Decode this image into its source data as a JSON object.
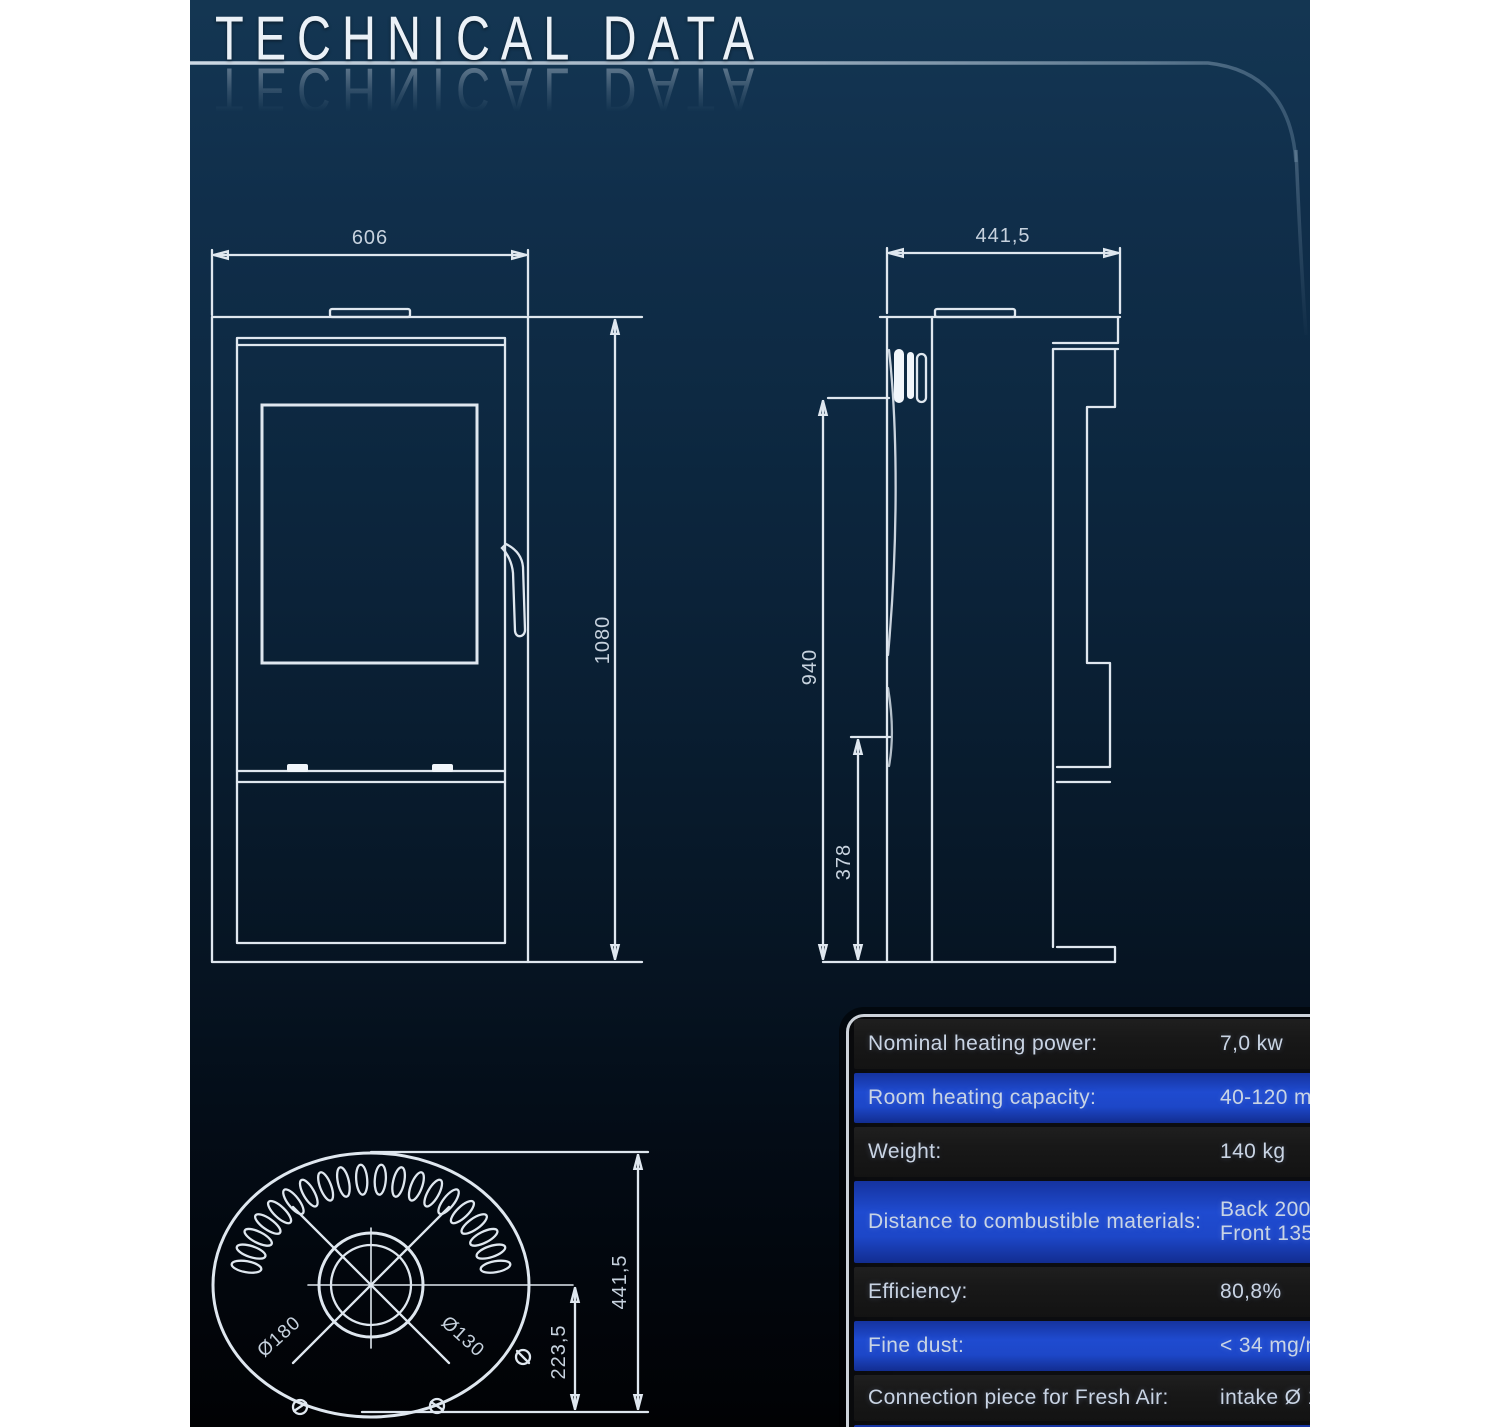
{
  "page": {
    "title": "TECHNICAL DATA"
  },
  "front_view": {
    "width_label": "606",
    "height_label": "1080"
  },
  "side_view": {
    "depth_label": "441,5",
    "height_label": "940",
    "lower_height_label": "378"
  },
  "top_view": {
    "outer_diameter_label": "Ø180",
    "inner_diameter_label": "Ø130",
    "offset_label": "223,5",
    "depth_label": "441,5"
  },
  "spec_table": {
    "rows": [
      {
        "label": "Nominal heating power:",
        "value": "7,0 kw"
      },
      {
        "label": "Room heating capacity:",
        "value": "40-120 m²"
      },
      {
        "label": "Weight:",
        "value": "140 kg"
      },
      {
        "label": "Distance to combustible materials:",
        "value": "Back 200mm/Side 200mm/\nFront 1350mm"
      },
      {
        "label": "Efficiency:",
        "value": "80,8%"
      },
      {
        "label": "Fine dust:",
        "value": "< 34 mg/m³"
      },
      {
        "label": "Connection piece for Fresh Air:",
        "value": "intake Ø 100mm"
      }
    ]
  },
  "colors": {
    "panel_top": "#143652",
    "panel_bottom": "#010204",
    "row_blue": "#1d47c8",
    "row_dark": "#181818",
    "line": "#dfe7ef"
  }
}
